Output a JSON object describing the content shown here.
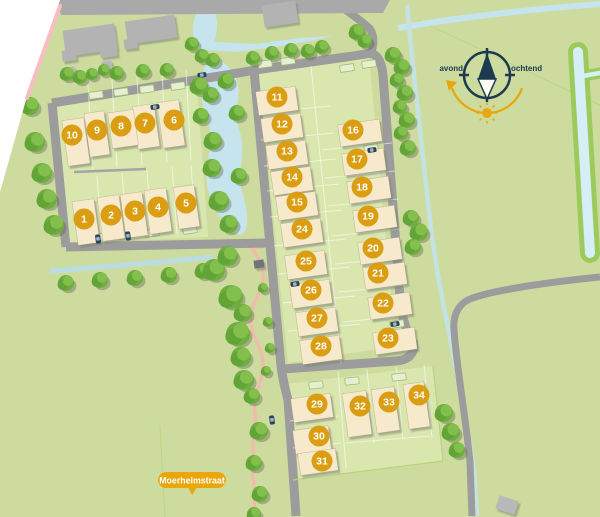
{
  "street_label": {
    "text": "Moerheimstraat"
  },
  "compass": {
    "west_label": "avond",
    "east_label": "ochtend"
  },
  "plots": [
    {
      "number": 1,
      "x": 84,
      "y": 219
    },
    {
      "number": 2,
      "x": 111,
      "y": 215
    },
    {
      "number": 3,
      "x": 135,
      "y": 211
    },
    {
      "number": 4,
      "x": 158,
      "y": 207
    },
    {
      "number": 5,
      "x": 186,
      "y": 203
    },
    {
      "number": 6,
      "x": 174,
      "y": 120
    },
    {
      "number": 7,
      "x": 145,
      "y": 123
    },
    {
      "number": 8,
      "x": 121,
      "y": 126
    },
    {
      "number": 9,
      "x": 97,
      "y": 130
    },
    {
      "number": 10,
      "x": 72,
      "y": 135
    },
    {
      "number": 11,
      "x": 277,
      "y": 97
    },
    {
      "number": 12,
      "x": 282,
      "y": 124
    },
    {
      "number": 13,
      "x": 287,
      "y": 151
    },
    {
      "number": 14,
      "x": 292,
      "y": 177
    },
    {
      "number": 15,
      "x": 297,
      "y": 202
    },
    {
      "number": 16,
      "x": 353,
      "y": 130
    },
    {
      "number": 17,
      "x": 357,
      "y": 159
    },
    {
      "number": 18,
      "x": 362,
      "y": 187
    },
    {
      "number": 19,
      "x": 368,
      "y": 216
    },
    {
      "number": 20,
      "x": 373,
      "y": 248
    },
    {
      "number": 21,
      "x": 378,
      "y": 273
    },
    {
      "number": 22,
      "x": 383,
      "y": 303
    },
    {
      "number": 23,
      "x": 388,
      "y": 338
    },
    {
      "number": 24,
      "x": 302,
      "y": 229
    },
    {
      "number": 25,
      "x": 306,
      "y": 261
    },
    {
      "number": 26,
      "x": 311,
      "y": 290
    },
    {
      "number": 27,
      "x": 317,
      "y": 318
    },
    {
      "number": 28,
      "x": 321,
      "y": 346
    },
    {
      "number": 29,
      "x": 317,
      "y": 404
    },
    {
      "number": 30,
      "x": 319,
      "y": 436
    },
    {
      "number": 31,
      "x": 322,
      "y": 461
    },
    {
      "number": 32,
      "x": 360,
      "y": 406
    },
    {
      "number": 33,
      "x": 389,
      "y": 402
    },
    {
      "number": 34,
      "x": 419,
      "y": 395
    }
  ],
  "colors": {
    "background": "#ffffff",
    "field_green": "#cddc9e",
    "parcel_green": "#d9e7af",
    "road_gray": "#9c9c9c",
    "road_band_gray": "#a9a9a9",
    "water_blue": "#c6e4ee",
    "ditch_bank_green": "#9ccb5d",
    "house_fill": "#f7e9cb",
    "building_gray": "#b3b3b3",
    "marker_orange": "#db9e12",
    "tree_green": "#6fae3e",
    "path_pink": "#efbcab",
    "boundary_pink": "#f8bdc3",
    "compass_navy": "#1d3a4e",
    "accent_amber": "#e9a70b"
  }
}
